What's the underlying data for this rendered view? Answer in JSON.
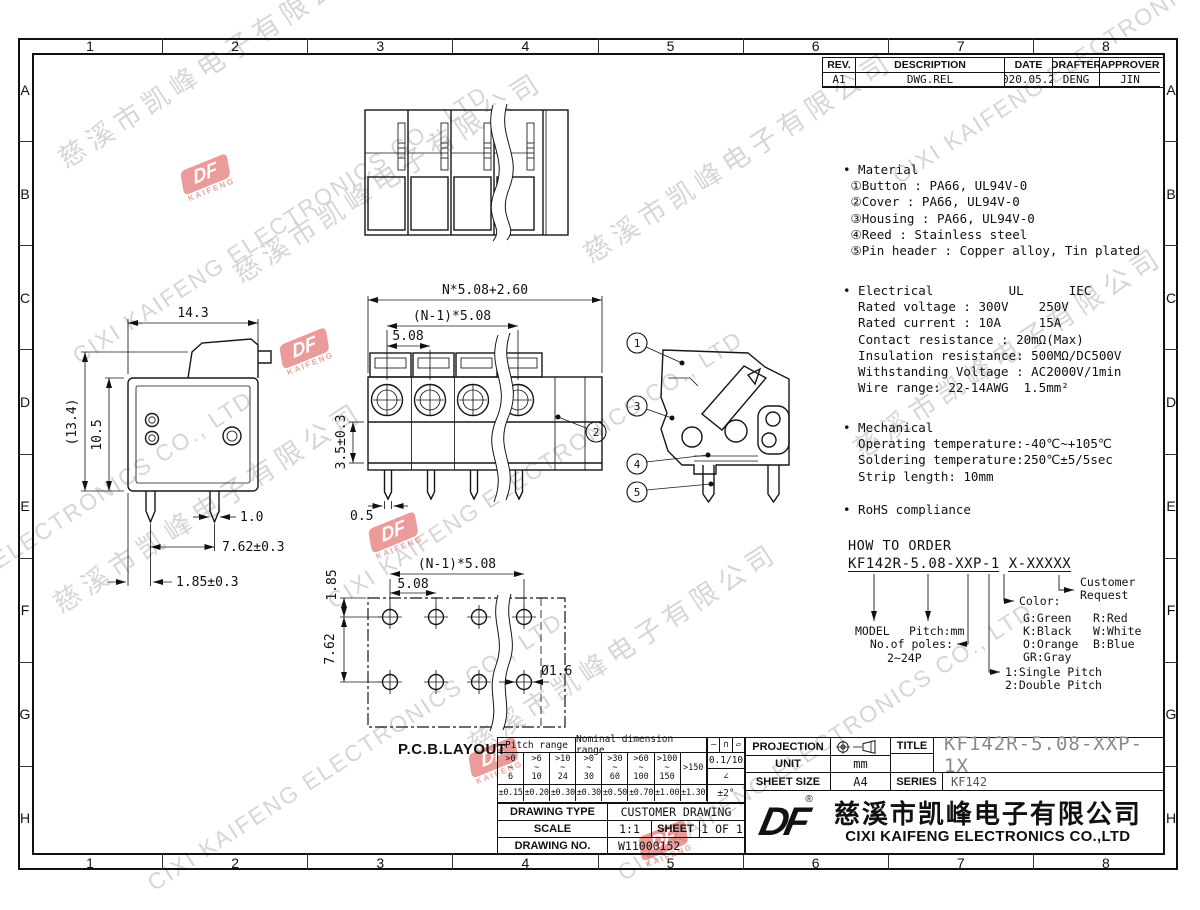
{
  "sheet": {
    "zone_numbers": [
      "1",
      "2",
      "3",
      "4",
      "5",
      "6",
      "7",
      "8"
    ],
    "zone_letters": [
      "A",
      "B",
      "C",
      "D",
      "E",
      "F",
      "G",
      "H"
    ]
  },
  "revision_table": {
    "headers": [
      "REV.",
      "DESCRIPTION",
      "DATE",
      "DRAFTER",
      "APPROVER"
    ],
    "row": [
      "A1",
      "DWG.REL",
      "2020.05.27",
      "DENG",
      "JIN"
    ]
  },
  "notes": {
    "material": [
      "• Material",
      " ①Button : PA66, UL94V-0",
      " ②Cover : PA66, UL94V-0",
      " ③Housing : PA66, UL94V-0",
      " ④Reed : Stainless steel",
      " ⑤Pin header : Copper alloy, Tin plated"
    ],
    "electrical": [
      "• Electrical          UL      IEC",
      "  Rated voltage : 300V    250V",
      "  Rated current : 10A     15A",
      "  Contact resistance : 20mΩ(Max)",
      "  Insulation resistance: 500MΩ/DC500V",
      "  Withstanding Voltage : AC2000V/1min",
      "  Wire range: 22-14AWG  1.5mm²"
    ],
    "mechanical": [
      "• Mechanical",
      "  Operating temperature:-40℃~+105℃",
      "  Soldering temperature:250℃±5/5sec",
      "  Strip length: 10mm"
    ],
    "rohs": [
      "• RoHS compliance"
    ]
  },
  "how_to_order": {
    "title": "HOW TO ORDER",
    "code": "KF142R-5.08-XXP-1 X-XXXXX",
    "model_label": "MODEL",
    "pitch_label": "Pitch:mm",
    "poles_label": "No.of poles:",
    "poles_range": "2~24P",
    "pitch_type_1": "1:Single Pitch",
    "pitch_type_2": "2:Double Pitch",
    "color_label": "Color:",
    "colors_col1": [
      "G:Green",
      "K:Black",
      "O:Orange",
      "GR:Gray"
    ],
    "colors_col2": [
      "R:Red",
      "W:White",
      "B:Blue"
    ],
    "customer_1": "Customer",
    "customer_2": "Request"
  },
  "views": {
    "side": {
      "dim_width": "14.3",
      "dim_height_overall": "(13.4)",
      "dim_height_body": "10.5",
      "dim_pin_width": "1.0",
      "dim_pin_pitch": "7.62±0.3",
      "dim_edge": "1.85±0.3"
    },
    "front": {
      "dim_overall": "N*5.08+2.60",
      "dim_span": "(N-1)*5.08",
      "dim_pitch": "5.08",
      "dim_height": "3.5±0.3",
      "dim_pin": "0.5",
      "balloon": "2"
    },
    "detail": {
      "balloons": [
        "1",
        "3",
        "4",
        "5"
      ]
    },
    "pcb": {
      "label": "P.C.B.LAYOUT",
      "dim_span": "(N-1)*5.08",
      "dim_pitch": "5.08",
      "dim_row": "7.62",
      "dim_offset": "1.85",
      "dim_hole": "Ø1.6"
    }
  },
  "tolerance_table": {
    "pitch_header": "Pitch range",
    "nominal_header": "Nominal dimension range",
    "symbols": [
      "—",
      "∩",
      "▱"
    ],
    "ranges": [
      ">0\n~\n6",
      ">6\n~\n10",
      ">10\n~\n24",
      ">0\n~\n30",
      ">30\n~\n60",
      ">60\n~\n100",
      ">100\n~\n150",
      ">150"
    ],
    "tolerances": [
      "±0.15",
      "±0.20",
      "±0.30",
      "±0.30",
      "±0.50",
      "±0.70",
      "±1.00",
      "±1.30"
    ],
    "flatness": "0.1/10",
    "angle_symbol": "∠",
    "angle_tol": "±2°"
  },
  "title_block": {
    "drawing_type_label": "DRAWING TYPE",
    "drawing_type": "CUSTOMER DRAWING",
    "scale_label": "SCALE",
    "scale": "1:1",
    "sheet_label": "SHEET",
    "sheet": "1 OF 1",
    "drawing_no_label": "DRAWING NO.",
    "drawing_no": "W11000152",
    "projection_label": "PROJECTION",
    "unit_label": "UNIT",
    "unit": "mm",
    "sheet_size_label": "SHEET SIZE",
    "sheet_size": "A4",
    "title_label": "TITLE",
    "title": "KF142R-5.08-XXP-1X",
    "series_label": "SERIES",
    "series": "KF142",
    "company_cn": "慈溪市凯峰电子有限公司",
    "company_en": "CIXI KAIFENG ELECTRONICS CO.,LTD",
    "logo_text": "DF",
    "registered": "®"
  },
  "watermark": {
    "cn": "慈溪市凯峰电子有限公司",
    "en": "CIXI KAIFENG ELECTRONICS CO., LTD",
    "logo": "DF",
    "logo_sub": "KAIFENG"
  }
}
